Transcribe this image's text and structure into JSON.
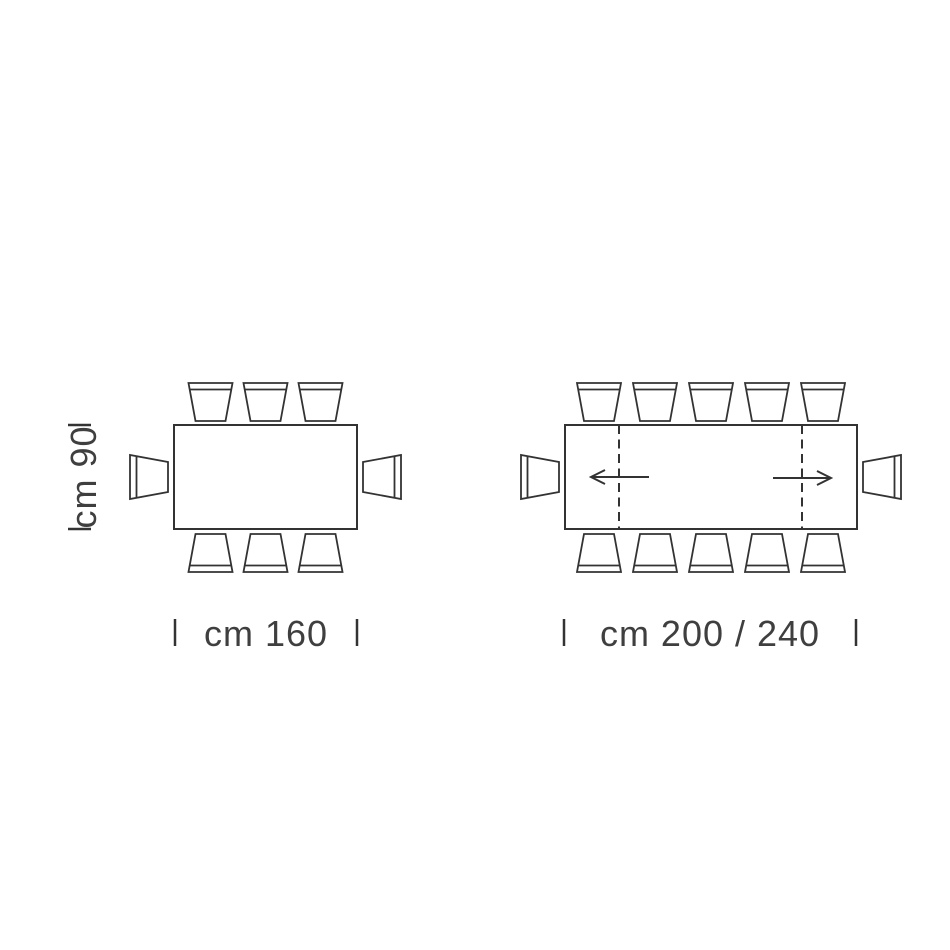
{
  "canvas": {
    "background": "#ffffff",
    "line_color": "#333333",
    "text_color": "#3f3f3f"
  },
  "diagram": {
    "kind": "dining-table-seating-dimension-plan-top-view",
    "depth_label": "cm 90",
    "tables": [
      {
        "id": "fixed-table",
        "width_label": "cm 160",
        "extendable": false,
        "seats_top": 3,
        "seats_bottom": 3,
        "seats_left": 1,
        "seats_right": 1,
        "total_seats": 8
      },
      {
        "id": "extendable-table",
        "width_label": "cm 200 / 240",
        "extendable": true,
        "extension_leaf_lines": 2,
        "extension_arrows": [
          "left",
          "right"
        ],
        "seats_top": 5,
        "seats_bottom": 5,
        "seats_left": 1,
        "seats_right": 1,
        "total_seats": 12
      }
    ]
  }
}
